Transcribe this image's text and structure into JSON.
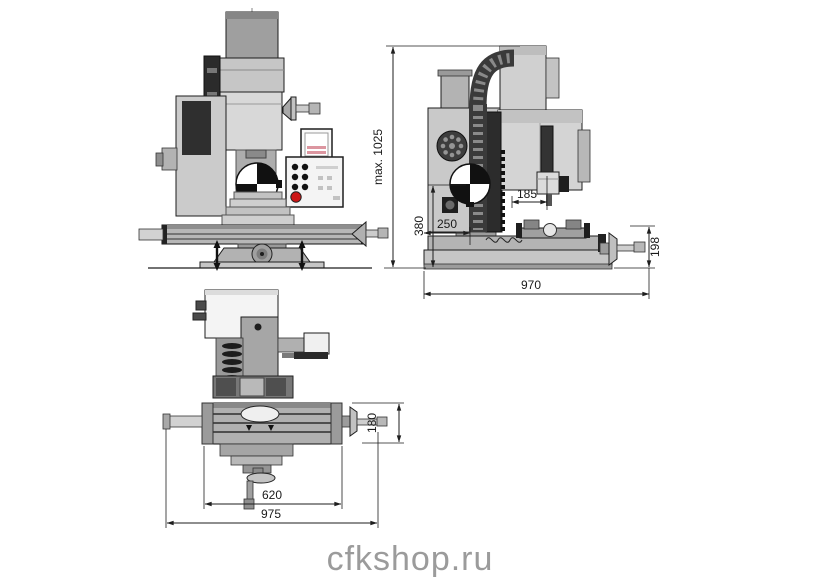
{
  "watermark": "cfkshop.ru",
  "drawing": {
    "type": "milling-machine-dimensional-drawing",
    "views": {
      "front": "front view",
      "side": "side view",
      "top": "top view"
    }
  },
  "dimensions": {
    "max_height": "max. 1025",
    "cog_height": "380",
    "spindle_to_column": "185",
    "column_to_base_front": "250",
    "total_depth": "970",
    "table_height": "198",
    "table_width": "180",
    "table_length": "620",
    "total_width": "975"
  },
  "colors": {
    "body_light": "#d6d6d6",
    "body_mid": "#b4b4b4",
    "body_dark": "#8f8f8f",
    "line_dark": "#1e1e1e",
    "emergency_stop": "#cc1616",
    "display_rows": "#dc96a0",
    "watermark_gray": "#9b9b9b"
  }
}
